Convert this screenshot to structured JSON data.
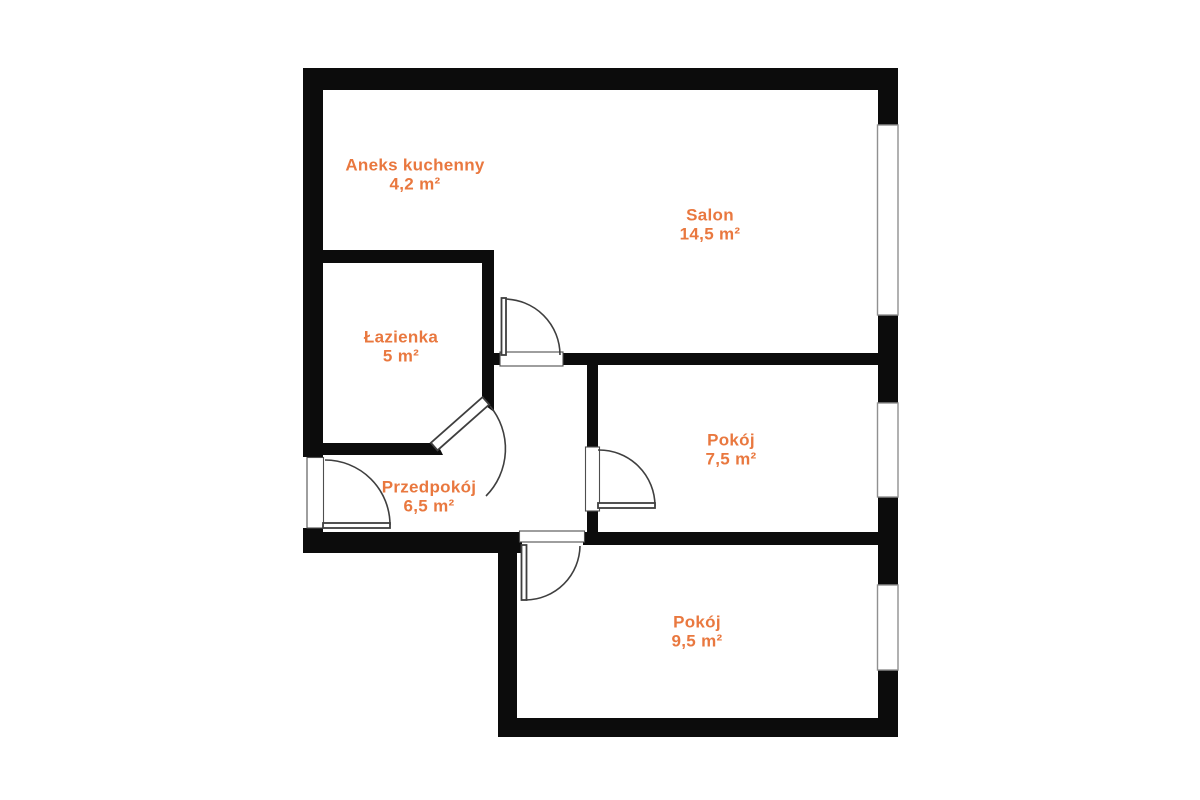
{
  "colors": {
    "bg": "#ffffff",
    "wall": "#0c0c0c",
    "label": "#e9783f",
    "door_line": "#3f3f3f",
    "window_border": "#909090",
    "threshold_border": "#4e4e4e"
  },
  "rooms": [
    {
      "id": "aneks-kuchenny",
      "name": "Aneks kuchenny",
      "area": "4,2 m²"
    },
    {
      "id": "salon",
      "name": "Salon",
      "area": "14,5 m²"
    },
    {
      "id": "lazienka",
      "name": "Łazienka",
      "area": "5 m²"
    },
    {
      "id": "przedpokoj",
      "name": "Przedpokój",
      "area": "6,5 m²"
    },
    {
      "id": "pokoj-1",
      "name": "Pokój",
      "area": "7,5 m²"
    },
    {
      "id": "pokoj-2",
      "name": "Pokój",
      "area": "9,5 m²"
    }
  ]
}
